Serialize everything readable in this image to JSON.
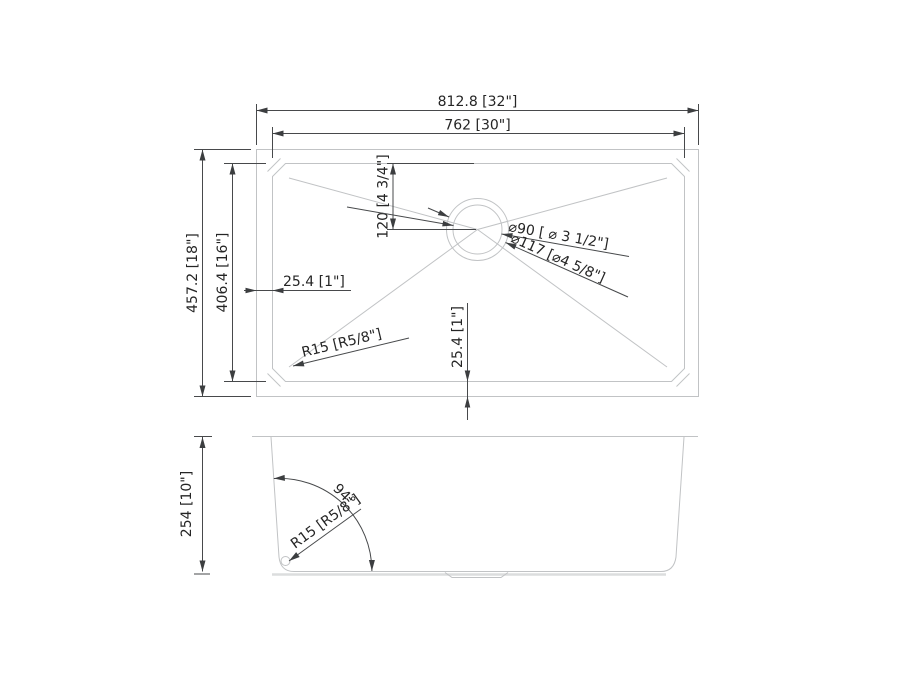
{
  "top_view": {
    "overall_width": "812.8  [32\"]",
    "inner_width": "762 [30\"]",
    "overall_depth": "457.2 [18\"]",
    "inner_depth": "406.4 [16\"]",
    "drain_offset": "120 [4 3/4\"]",
    "rim_left": "25.4 [1\"]",
    "rim_bottom": "25.4 [1\"]",
    "corner_radius": "R15 [R5/8\"]",
    "drain_diameter_inner": "⌀90 [ ⌀ 3 1/2\"]",
    "drain_diameter_outer": "⌀117 [⌀4 5/8\"]"
  },
  "side_view": {
    "height": "254 [10\"]",
    "wall_angle": "94°",
    "bottom_corner_radius": "R15 [R5/8\"]"
  }
}
